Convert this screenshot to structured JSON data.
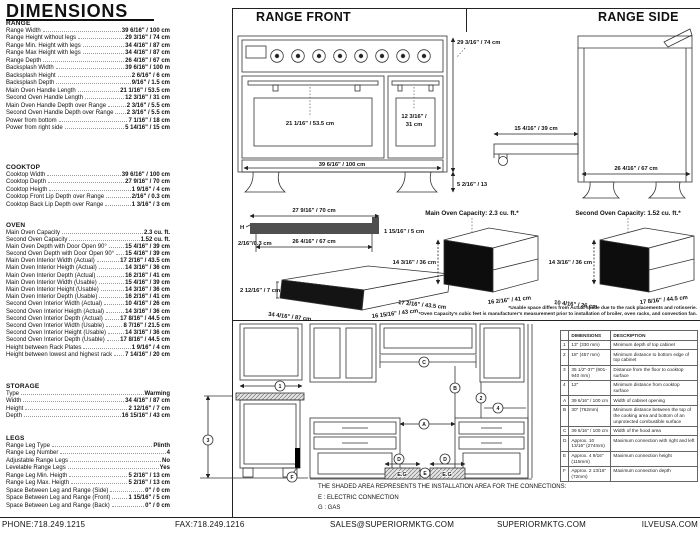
{
  "title": "DIMENSIONS",
  "specs": {
    "sections": [
      {
        "name": "RANGE",
        "rows": [
          {
            "label": "Range Width",
            "value": "39 6/16\" / 100 cm"
          },
          {
            "label": "Range Height without legs",
            "value": "29 3/16\" / 74 cm"
          },
          {
            "label": "Range Min. Height with legs",
            "value": "34 4/16\" / 87 cm"
          },
          {
            "label": "Range Max Height with legs",
            "value": "34 4/16\" / 87 cm"
          },
          {
            "label": "Range Depth",
            "value": "26 4/16\" / 67 cm"
          },
          {
            "label": "Backsplash Width",
            "value": "39 6/16\" / 100 m"
          },
          {
            "label": "Backsplash Height",
            "value": "2 6/16\" / 6 cm"
          },
          {
            "label": "Backsplash Depth",
            "value": "9/16\" / 1.5 cm"
          },
          {
            "label": "Main Oven Handle Length",
            "value": "21 1/16\" / 53.5 cm"
          },
          {
            "label": "Second Oven Handle Length",
            "value": "12 3/16\" / 31 cm"
          },
          {
            "label": "Main Oven Handle Depth over Range",
            "value": "2 3/16\" / 5.5 cm"
          },
          {
            "label": "Second Oven Handle Depth over Range",
            "value": "2 3/16\" / 5.5 cm"
          },
          {
            "label": "Power from bottom",
            "value": "7 1/16\" / 18 cm"
          },
          {
            "label": "Power from right side",
            "value": "5 14/16\" / 15 cm"
          }
        ]
      },
      {
        "name": "COOKTOP",
        "rows": [
          {
            "label": "Cooktop Width",
            "value": "39 6/16\" / 100 cm"
          },
          {
            "label": "Cooktop Depth",
            "value": "27 9/16\" / 70 cm"
          },
          {
            "label": "Cooktop Heigth",
            "value": "1 9/16\" / 4 cm"
          },
          {
            "label": "Cooktop Front Lip Depth over Range",
            "value": "2/16\" / 0.3 cm"
          },
          {
            "label": "Cooktop Back Lip Depth over Range",
            "value": "1 3/16\" / 3 cm"
          }
        ]
      },
      {
        "name": "OVEN",
        "rows": [
          {
            "label": "Main Oven Capacity",
            "value": "2.3 cu. ft."
          },
          {
            "label": "Second Oven Capacity",
            "value": "1.52 cu. ft."
          },
          {
            "label": "Main Oven Depth with Door Open 90°",
            "value": "15 4/16\" / 39 cm"
          },
          {
            "label": "Second Oven Depth with Door Open 90°",
            "value": "15 4/16\" / 39 cm"
          },
          {
            "label": "Main Oven Interior Width (Actual)",
            "value": "17 2/16\" / 43.5 cm"
          },
          {
            "label": "Main Oven Interior Heigth (Actual)",
            "value": "14 3/16\" / 36 cm"
          },
          {
            "label": "Main Oven Interior Depth (Actual)",
            "value": "16 2/16\" / 41 cm"
          },
          {
            "label": "Main Oven Interior Width (Usable)",
            "value": "15 4/16\" / 39 cm"
          },
          {
            "label": "Main Oven Interior Height (Usable)",
            "value": "14 3/16\" / 36 cm"
          },
          {
            "label": "Main Oven Interior Depth (Usable)",
            "value": "16 2/16\" / 41 cm"
          },
          {
            "label": "Second Oven Interior Width (Actual)",
            "value": "10 4/16\" / 26 cm"
          },
          {
            "label": "Second Oven Interior Heigth (Actual)",
            "value": "14 3/16\" / 36 cm"
          },
          {
            "label": "Second Oven Interior Depth (Actual)",
            "value": "17 8/16\" / 44.5 cm"
          },
          {
            "label": "Second Oven Interior Width (Usable)",
            "value": "8 7/16\" / 21.5 cm"
          },
          {
            "label": "Second Oven Interior Height (Usable)",
            "value": "14 3/16\" / 36 cm"
          },
          {
            "label": "Second Oven Interior Depth (Usable)",
            "value": "17 8/16\" / 44.5 cm"
          },
          {
            "label": "Height between Rack Plates",
            "value": "1 9/16\" / 4 cm"
          },
          {
            "label": "Height between lowest and highest rack",
            "value": "7 14/16\" / 20 cm"
          }
        ]
      },
      {
        "name": "STORAGE",
        "rows": [
          {
            "label": "Type",
            "value": "Warming"
          },
          {
            "label": "Width",
            "value": "34 4/16\" / 87 cm"
          },
          {
            "label": "Height",
            "value": "2 12/16\" / 7 cm"
          },
          {
            "label": "Depth",
            "value": "16 15/16\" / 43 cm"
          }
        ]
      },
      {
        "name": "LEGS",
        "rows": [
          {
            "label": "Range Leg Type",
            "value": "Plinth"
          },
          {
            "label": "Range Leg Number",
            "value": "4"
          },
          {
            "label": "Adjustable Range Legs",
            "value": "No"
          },
          {
            "label": "Levelable Range Legs",
            "value": "Yes"
          },
          {
            "label": "Range Leg Min. Heigth",
            "value": "5 2/16\" / 13 cm"
          },
          {
            "label": "Range Leg Max. Heigth",
            "value": "5 2/16\" / 13 cm"
          },
          {
            "label": "Space Between Leg and Range (Side)",
            "value": "0\" / 0 cm"
          },
          {
            "label": "Space Between Leg and Range (Front)",
            "value": "1 15/16\" / 5 cm"
          },
          {
            "label": "Space Between Leg and Range (Back)",
            "value": "0\" / 0 cm"
          }
        ]
      }
    ]
  },
  "diagrams": {
    "range_front": {
      "title": "RANGE FRONT",
      "height_label": "29 3/16\" / 74 cm",
      "main_handle_label": "21 1/16\" / 53.5 cm",
      "second_door_line1": "12 3/16\" /",
      "second_door_line2": "31 cm",
      "width_label": "39 6/16\" / 100 cm",
      "leg_label": "5 2/16\" / 13"
    },
    "range_side": {
      "title": "RANGE SIDE",
      "door_label": "15 4/16\" / 39 cm",
      "depth_label": "26 4/16\" / 67 cm"
    },
    "cooktop_profile": {
      "top_label": "27 9/16\" / 70 cm",
      "inner_label": "26 4/16\" / 67 cm",
      "h_label": "H",
      "front_lip_label": "2/16\"/0.3 cm",
      "back_label": "1 15/16\" / 5 cm"
    },
    "storage_drawer": {
      "height_label": "2 12/16\" / 7 cm",
      "width_label": "34 4/16\" / 87 cm",
      "depth_label": "16 15/16\" / 43 cm"
    },
    "main_oven": {
      "title": "Main Oven Capacity: 2.3 cu. ft.*",
      "height_label": "14 3/16\" / 36 cm",
      "width_label": "17 2/16\" / 43.5 cm",
      "depth_label": "16 2/16\" / 41 cm"
    },
    "second_oven": {
      "title": "Second Oven Capacity: 1.52 cu. ft.*",
      "height_label": "14 3/16\" / 36 cm",
      "width_label": "10 4/16\" / 26 cm",
      "depth_label": "17 8/16\" / 44.5 cm"
    },
    "footnote1": "*Usable space differs from Actual space due to the rack placements and rotisserie.",
    "footnote2": "*Oven Capacity's cubic feet is manufacturer's measurement prior to installation of broiler, oven racks, and convection fan."
  },
  "installation": {
    "markers": {
      "m1": "1",
      "m2": "2",
      "m3": "3",
      "m4": "4",
      "a": "A",
      "b": "B",
      "c": "C",
      "d": "D",
      "e": "E",
      "f": "F"
    },
    "shaded_label": "E.G",
    "note": "THE SHADED AREA REPRESENTS THE INSTALLATION AREA FOR THE CONNECTIONS:",
    "legend_e": "E : ELECTRIC CONNECTION",
    "legend_g": "G : GAS"
  },
  "table": {
    "headers": [
      "",
      "DIMENSIONS",
      "DESCRIPTION"
    ],
    "rows": [
      [
        "1",
        "13\" (330 mm)",
        "Minimum depth of top cabinet"
      ],
      [
        "2",
        "18\" (457 mm)",
        "Minimum distance to bottom edge of top cabinet"
      ],
      [
        "3",
        "35 1/2\"-37\" (901-940 mm)",
        "Distance from the floor to cooktop surface"
      ],
      [
        "4",
        "12\"",
        "Minimum distance from cooktop surface"
      ],
      [
        "A",
        "39 6/16\" / 100 cm",
        "Width of cabinet opening"
      ],
      [
        "B",
        "30\" (762mm)",
        "Minimum distance between the top of the cooking area and bottom of an unprotected combustible surface"
      ],
      [
        "C",
        "39 6/16\" / 100 cm",
        "Width of the hood area"
      ],
      [
        "D",
        "Approx. 10 13/16\" (274mm)",
        "Maximum connection with right and left"
      ],
      [
        "E",
        "Approx. 4 9/16\" (115mm)",
        "Maximum connection height"
      ],
      [
        "F",
        "Approx. 2 13/16\" (72mm)",
        "Maximum connection depth"
      ]
    ]
  },
  "footer": {
    "phone": "PHONE:718.249.1215",
    "fax": "FAX:718.249.1216",
    "email": "SALES@SUPERIORMKTG.COM",
    "website": "SUPERIORMKTG.COM",
    "brand": "ILVEUSA.COM"
  }
}
